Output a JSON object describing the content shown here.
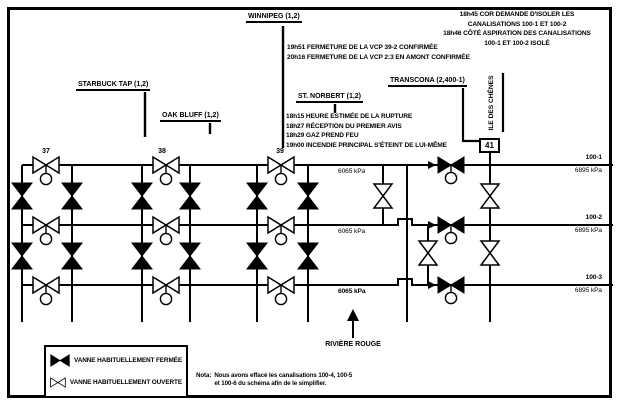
{
  "colors": {
    "ink": "#000000",
    "background": "#ffffff"
  },
  "top_right_log": [
    "18h45 COR DEMANDE D'ISOLER LES",
    "CANALISATIONS 100-1 ET 100-2",
    "18h46 CÔTÉ ASPIRATION DES CANALISATIONS",
    "100-1 ET 100-2 ISOLÉ"
  ],
  "vcp_log": [
    "19h51 FERMETURE DE LA VCP 39-2 CONFIRMÉE",
    "20h16 FERMETURE DE LA VCP 2:3 EN AMONT CONFIRMÉE"
  ],
  "rupture_log": [
    "18h15 HEURE ESTIMÉE DE LA RUPTURE",
    "18h27 RÉCEPTION DU PREMIER AVIS",
    "18h29 GAZ PREND FEU",
    "19h00 INCENDIE PRINCIPAL S'ÉTEINT DE LUI-MÊME"
  ],
  "stations": {
    "winnipeg": "WINNIPEG (1,2)",
    "starbuck_tap": "STARBUCK TAP (1,2)",
    "oak_bluff": "OAK BLUFF (1,2)",
    "st_norbert": "ST. NORBERT (1,2)",
    "transcona": "TRANSCONA (2,400-1)",
    "ile_des_chenes": "ILE DES CHÊNES",
    "riviere_rouge": "RIVIÈRE ROUGE"
  },
  "valve_numbers": {
    "v37": "37",
    "v38": "38",
    "v39": "39",
    "v41": "41"
  },
  "pipelines": [
    {
      "name": "100-1",
      "pressure_upstream": "6065 kPa",
      "pressure_downstream": "6895 kPa"
    },
    {
      "name": "100-2",
      "pressure_upstream": "6065 kPa",
      "pressure_downstream": "6895 kPa"
    },
    {
      "name": "100-3",
      "pressure_upstream": "6065 kPa",
      "pressure_downstream": "6895 kPa"
    }
  ],
  "legend": {
    "closed": "VANNE HABITUELLEMENT FERMÉE",
    "open": "VANNE HABITUELLEMENT OUVERTE"
  },
  "nota": {
    "label": "Nota:",
    "line1": "Nous avons effacé les canalisations 100-4, 100-5",
    "line2": "et 100-6 du schéma afin de le simplifier."
  }
}
